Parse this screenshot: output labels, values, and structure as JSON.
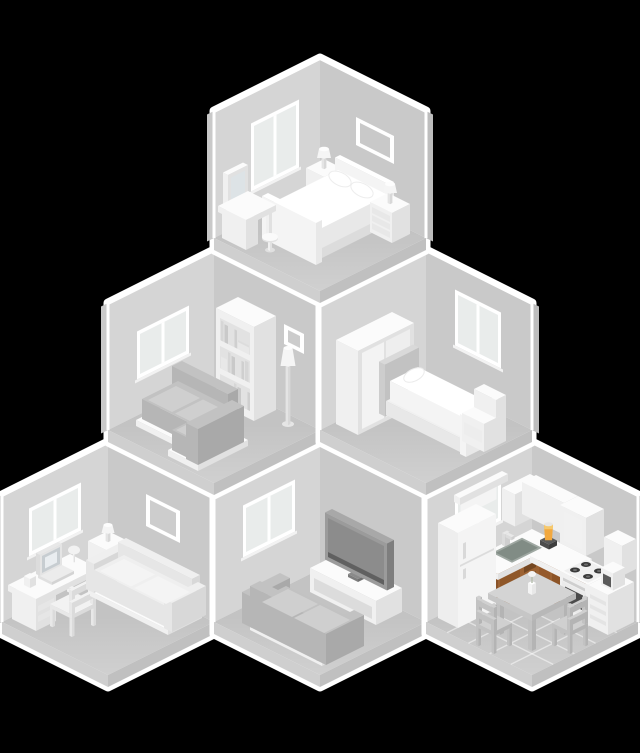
{
  "illustration": {
    "description": "Isometric cutaway of a house with six furnished rooms stacked in a pyramid; all rooms grayscale except the kitchen which is in color",
    "background_color": "#000000",
    "highlighted_room": "kitchen"
  },
  "palette": {
    "rim": "#ffffff",
    "wall_left": "#d5d5d5",
    "wall_right": "#c9c9c9",
    "floor": "#c3c3c3",
    "slab_left": "#cfcfcf",
    "slab_right": "#c0c0c0",
    "outer_left": "#c9c9c9",
    "outer_right": "#bdbdbd",
    "sofa_gray": "#c2c2c2",
    "tv_screen": "#8c8c8c",
    "kitchen_cabinet_front_dark": "#8a5329",
    "kitchen_cabinet_front_light": "#9c6233",
    "kitchen_cabinet_side": "#6f441f",
    "kitchen_sink": "#818c85",
    "kitchen_blender_jar": "#f2a83e",
    "kitchen_blender_base": "#4c4c4c",
    "kitchen_burner": "#3a3a3a",
    "kitchen_oven_window": "#4b4b4b"
  },
  "rooms": [
    {
      "id": "master-bedroom",
      "name": "Master bedroom",
      "position": "top",
      "furniture": [
        "window",
        "wall picture",
        "double bed",
        "two pillows",
        "corner nightstand with lamp",
        "nightstand with lamp",
        "vanity mirror",
        "vanity table",
        "round stool"
      ]
    },
    {
      "id": "living-room",
      "name": "Living room",
      "position": "middle-left",
      "furniture": [
        "window",
        "bookshelf with books",
        "wall picture",
        "floor lamp",
        "corner sofa"
      ]
    },
    {
      "id": "single-bedroom",
      "name": "Single bedroom",
      "position": "middle-right",
      "furniture": [
        "wardrobe",
        "single bed with pillow",
        "window",
        "stepped bedside unit"
      ]
    },
    {
      "id": "home-office",
      "name": "Home office",
      "position": "bottom-left",
      "furniture": [
        "window",
        "corner side table with lamp",
        "desk",
        "laptop",
        "desk lamp",
        "cup",
        "chair",
        "wall picture",
        "sofa"
      ]
    },
    {
      "id": "tv-room",
      "name": "TV room",
      "position": "bottom-middle",
      "furniture": [
        "window",
        "media stand",
        "flat-screen TV",
        "sofa"
      ]
    },
    {
      "id": "kitchen",
      "name": "Kitchen",
      "position": "bottom-right",
      "furniture": [
        "window with shade",
        "upper cabinets",
        "lower cabinets",
        "sink with faucet",
        "blender",
        "stove with oven",
        "drawer unit",
        "coffee maker",
        "fridge",
        "dining table",
        "vase with flower",
        "two chairs",
        "tiled floor"
      ]
    }
  ]
}
